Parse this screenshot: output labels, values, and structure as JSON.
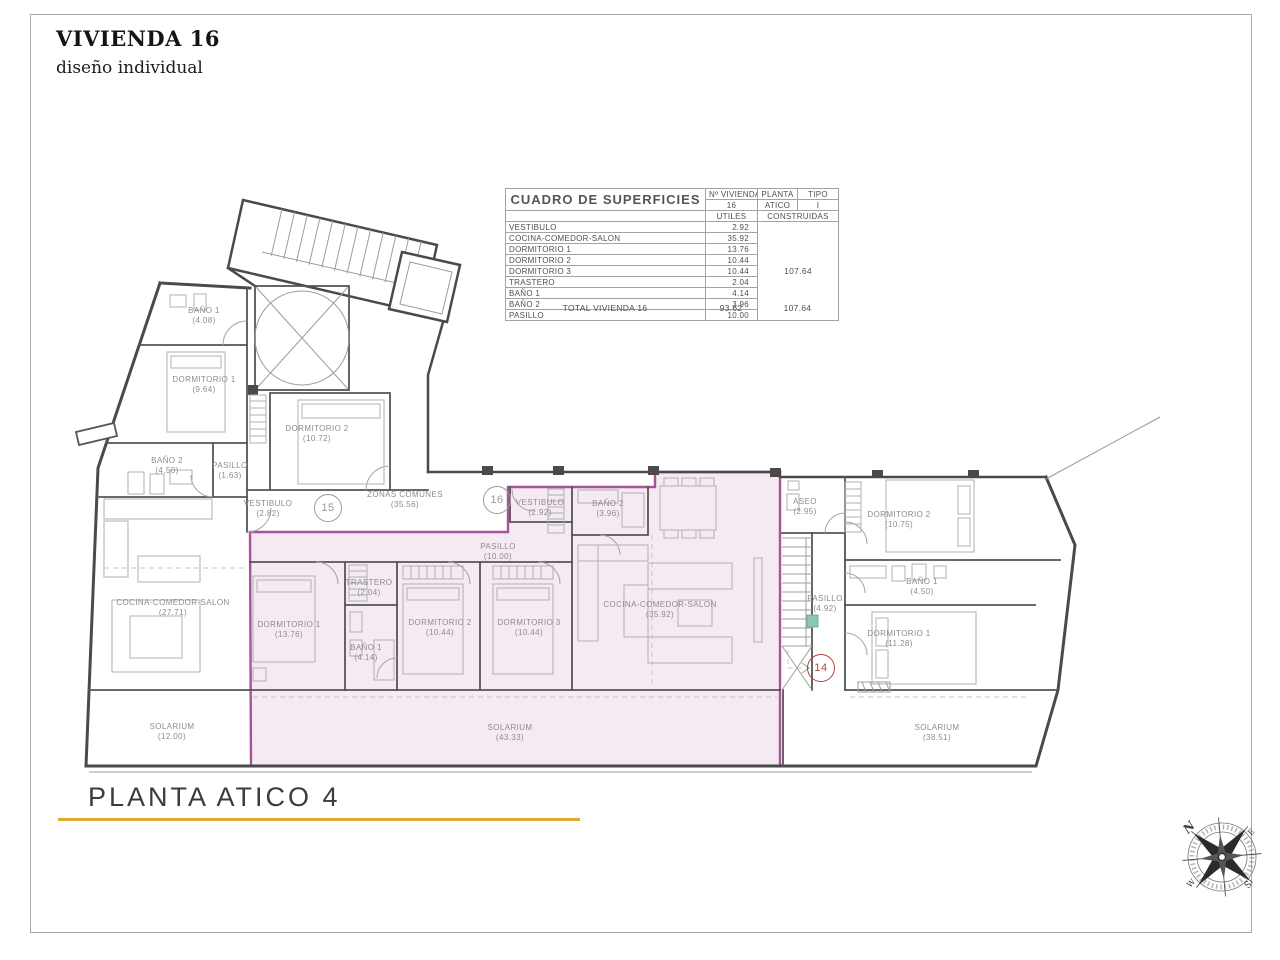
{
  "page": {
    "title": "VIVIENDA 16",
    "subtitle": "diseño individual",
    "footer_title": "PLANTA ATICO 4",
    "accent_color": "#E2AA2D",
    "highlight_fill": "#F5EAF4",
    "highlight_stroke": "#A9529B"
  },
  "table": {
    "title": "CUADRO DE SUPERFICIES",
    "headers": {
      "vivienda_label": "Nº VIVIENDA",
      "vivienda_value": "16",
      "planta_label": "PLANTA",
      "planta_value": "ATICO",
      "tipo_label": "TIPO",
      "tipo_value": "I",
      "utiles": "UTILES",
      "construidas": "CONSTRUIDAS"
    },
    "rows": [
      {
        "label": "VESTIBULO",
        "utiles": "2.92"
      },
      {
        "label": "COCINA-COMEDOR-SALON",
        "utiles": "35.92"
      },
      {
        "label": "DORMITORIO 1",
        "utiles": "13.76"
      },
      {
        "label": "DORMITORIO 2",
        "utiles": "10.44"
      },
      {
        "label": "DORMITORIO 3",
        "utiles": "10.44"
      },
      {
        "label": "TRASTERO",
        "utiles": "2.04"
      },
      {
        "label": "BAÑO 1",
        "utiles": "4.14"
      },
      {
        "label": "BAÑO 2",
        "utiles": "3.96"
      },
      {
        "label": "PASILLO",
        "utiles": "10.00"
      }
    ],
    "construidas_total": "107.64",
    "total": {
      "label": "TOTAL VIVIENDA 16",
      "utiles": "93.62",
      "construidas": "107.64"
    }
  },
  "plan": {
    "badges": [
      {
        "num": "15"
      },
      {
        "num": "16"
      },
      {
        "num": "14"
      }
    ],
    "rooms": [
      {
        "name": "BAÑO 1",
        "area": "(4.08)"
      },
      {
        "name": "DORMITORIO 1",
        "area": "(9.64)"
      },
      {
        "name": "DORMITORIO 2",
        "area": "(10.72)"
      },
      {
        "name": "BAÑO 2",
        "area": "(4.50)"
      },
      {
        "name": "PASILLO",
        "area": "(1.63)"
      },
      {
        "name": "VESTIBULO",
        "area": "(2.82)"
      },
      {
        "name": "COCINA-COMEDOR-SALON",
        "area": "(27.71)"
      },
      {
        "name": "SOLARIUM",
        "area": "(12.00)"
      },
      {
        "name": "ZONAS COMUNES",
        "area": "(35.56)"
      },
      {
        "name": "VESTIBULO",
        "area": "(2.92)"
      },
      {
        "name": "BAÑO 2",
        "area": "(3.96)"
      },
      {
        "name": "PASILLO",
        "area": "(10.00)"
      },
      {
        "name": "DORMITORIO 1",
        "area": "(13.76)"
      },
      {
        "name": "TRASTERO",
        "area": "(2.04)"
      },
      {
        "name": "BAÑO 1",
        "area": "(4.14)"
      },
      {
        "name": "DORMITORIO 2",
        "area": "(10.44)"
      },
      {
        "name": "DORMITORIO 3",
        "area": "(10.44)"
      },
      {
        "name": "COCINA-COMEDOR-SALON",
        "area": "(35.92)"
      },
      {
        "name": "SOLARIUM",
        "area": "(43.33)"
      },
      {
        "name": "ASEO",
        "area": "(2.95)"
      },
      {
        "name": "PASILLO",
        "area": "(4.92)"
      },
      {
        "name": "DORMITORIO 2",
        "area": "(10.75)"
      },
      {
        "name": "BAÑO 1",
        "area": "(4.50)"
      },
      {
        "name": "DORMITORIO 1",
        "area": "(11.28)"
      },
      {
        "name": "SOLARIUM",
        "area": "(38.51)"
      }
    ]
  },
  "compass": {
    "n": "N",
    "e": "E",
    "s": "S",
    "w": "W"
  }
}
